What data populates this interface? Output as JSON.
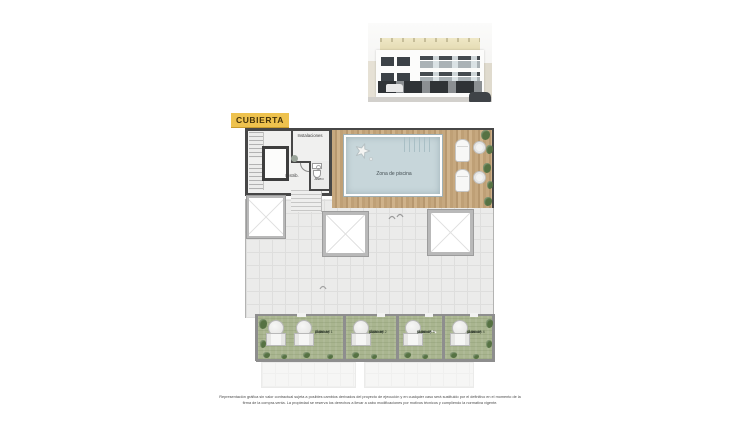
{
  "badge": {
    "label": "CUBIERTA"
  },
  "plan": {
    "rooms": {
      "instalaciones": "Instalaciones",
      "distrib": "Distrib.",
      "aseo": "Aseo",
      "pool_zone": "Zona de piscina"
    },
    "solariums": [
      {
        "name": "Solarium 1",
        "unit": "(Ático A)",
        "area": "21,50 m²"
      },
      {
        "name": "Solarium 2",
        "unit": "(Ático B)",
        "area": "13,70 m²"
      },
      {
        "name": "Solarium 3",
        "unit": "(Ático C)",
        "area": "11,90 m²"
      },
      {
        "name": "Solarium 4",
        "unit": "(Ático D)",
        "area": "11,80 m²"
      }
    ]
  },
  "disclaimer": {
    "text": "Representación gráfica sin valor contractual sujeta a posibles cambios derivados del proyecto de ejecución y en cualquier caso será sustituido por el definitivo en el momento de la firma de la compra-venta. La propiedad se reserva los derechos a llevar a cabo modificaciones por motivos técnicos y cumpliendo la normativa vigente."
  },
  "colors": {
    "badge_bg": "#eec24e",
    "badge_text": "#45330a",
    "wall_dark": "#474747",
    "wall_light": "#8e8e8e",
    "deck_wood": "#c0a078",
    "pool_water": "#c7d6da",
    "terrace_tile": "#ebebea",
    "solarium_green": "#a9b58f",
    "plant_green": "#567243"
  }
}
